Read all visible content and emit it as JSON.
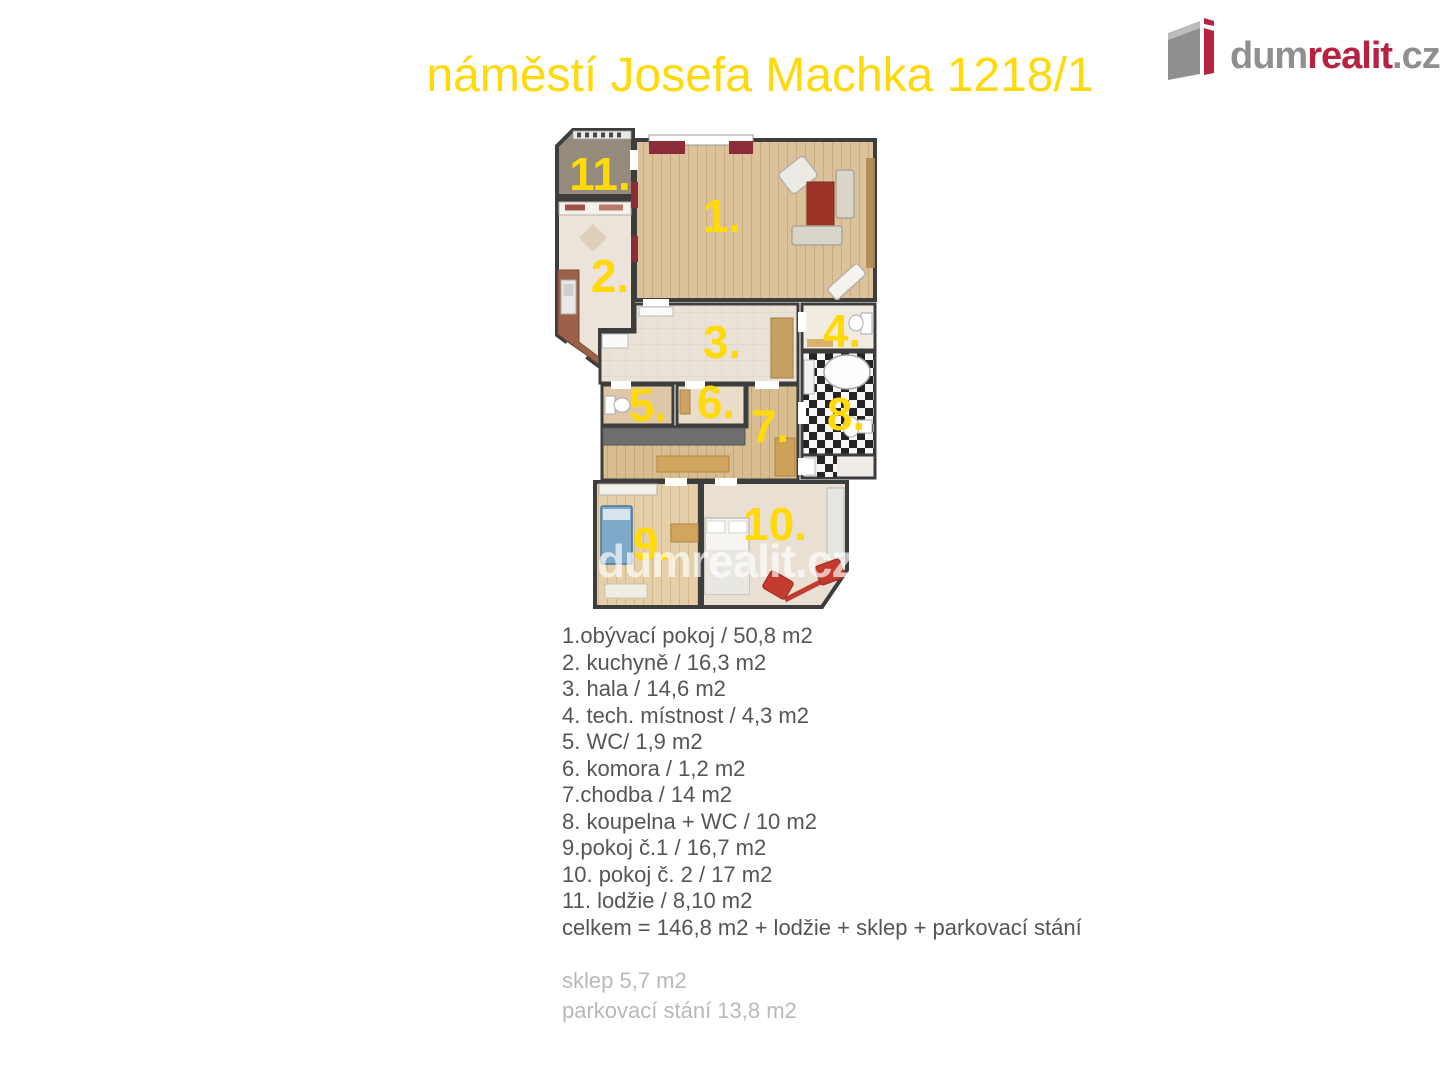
{
  "header": {
    "title": "náměstí Josefa Machka 1218/1",
    "title_color": "#ffd908"
  },
  "logo": {
    "dum": "dum",
    "realit": "realit",
    "cz": ".cz",
    "gray_color": "#8f8f90",
    "red_color": "#b62342"
  },
  "floorplan": {
    "watermark": "dumrealit.cz",
    "wall_color": "#3d3d3d",
    "label_color": "#ffd908",
    "rooms": [
      {
        "label": "1.",
        "name": "obývací pokoj"
      },
      {
        "label": "2.",
        "name": "kuchyně"
      },
      {
        "label": "3.",
        "name": "hala"
      },
      {
        "label": "4.",
        "name": "tech. místnost"
      },
      {
        "label": "5.",
        "name": "WC"
      },
      {
        "label": "6.",
        "name": "komora"
      },
      {
        "label": "7.",
        "name": "chodba"
      },
      {
        "label": "8.",
        "name": "koupelna + WC"
      },
      {
        "label": "9.",
        "name": "pokoj č.1"
      },
      {
        "label": "10.",
        "name": "pokoj č. 2"
      },
      {
        "label": "11.",
        "name": "lodžie"
      }
    ]
  },
  "legend": {
    "color": "#555558",
    "items": [
      "1.obývací pokoj / 50,8 m2",
      "2. kuchyně / 16,3 m2",
      "3. hala / 14,6 m2",
      "4. tech. místnost / 4,3 m2",
      "5. WC/ 1,9 m2",
      "6. komora / 1,2 m2",
      "7.chodba / 14 m2",
      "8. koupelna + WC  / 10 m2",
      "9.pokoj č.1 / 16,7 m2",
      "10. pokoj č. 2 / 17 m2",
      "11. lodžie / 8,10 m2",
      "celkem = 146,8 m2 + lodžie + sklep + parkovací stání"
    ]
  },
  "extras": {
    "color": "#b9b9b9",
    "items": [
      "sklep 5,7 m2",
      "parkovací stání 13,8 m2"
    ]
  }
}
